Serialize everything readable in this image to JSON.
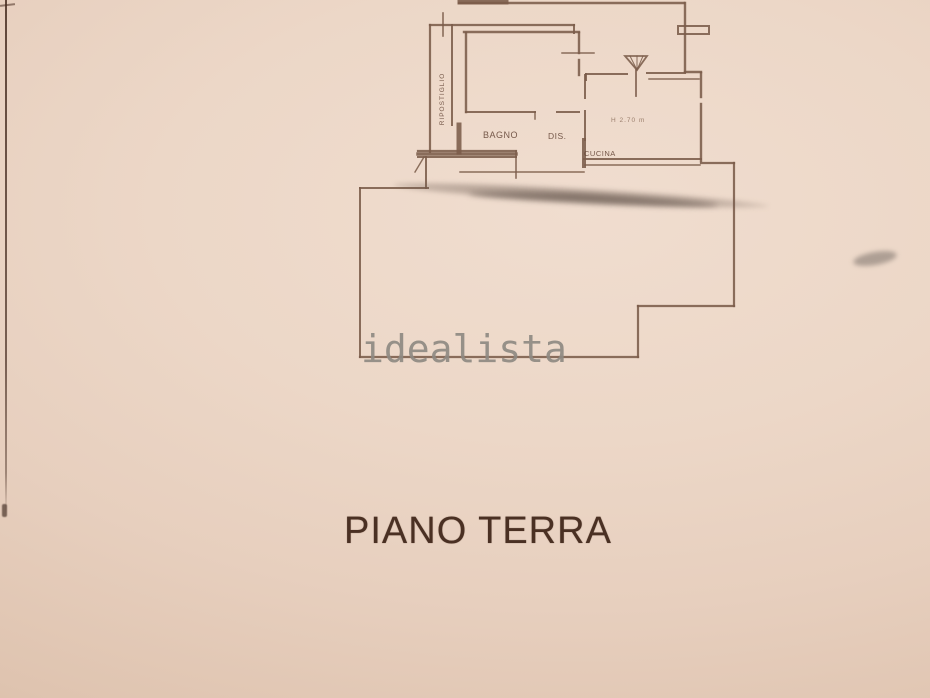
{
  "page": {
    "title": "PIANO TERRA",
    "watermark": "idealista"
  },
  "floor_plan": {
    "room_labels": {
      "ripostiglio": "RIPOSTIGLIO",
      "bagno": "BAGNO",
      "dis": "DIS.",
      "cucina": "CUCINA"
    },
    "annotations": {
      "ceiling_height": "H 2.70 m"
    }
  },
  "colors": {
    "paper": "#ecd7c7",
    "paper_edge": "#d8bba5",
    "ink": "#7b5c4a",
    "title_ink": "#4a3023",
    "watermark_gray": "#8f8a83",
    "smudge": "#68574d"
  }
}
